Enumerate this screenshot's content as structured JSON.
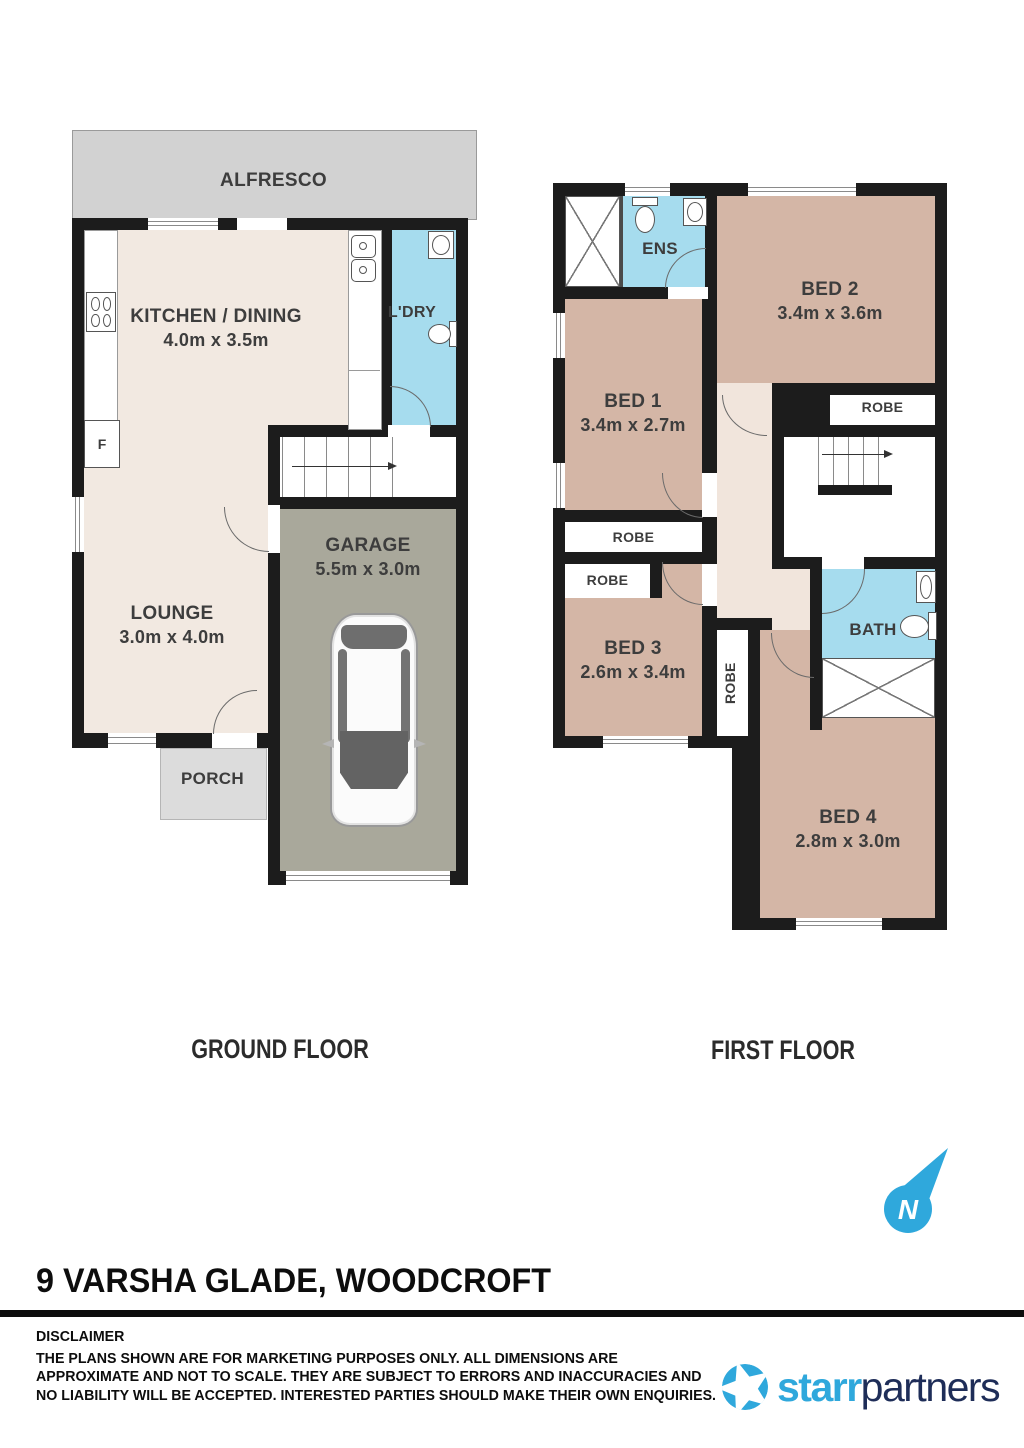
{
  "ground_floor": {
    "title": "GROUND FLOOR",
    "alfresco_label": "ALFRESCO",
    "kitchen_label": "KITCHEN / DINING",
    "kitchen_dims": "4.0m x 3.5m",
    "ldry_label": "L'DRY",
    "lounge_label": "LOUNGE",
    "lounge_dims": "3.0m x 4.0m",
    "garage_label": "GARAGE",
    "garage_dims": "5.5m x 3.0m",
    "porch_label": "PORCH",
    "fridge_label": "F"
  },
  "first_floor": {
    "title": "FIRST FLOOR",
    "ens_label": "ENS",
    "bed1_label": "BED 1",
    "bed1_dims": "3.4m x 2.7m",
    "bed2_label": "BED 2",
    "bed2_dims": "3.4m x 3.6m",
    "bed3_label": "BED 3",
    "bed3_dims": "2.6m x 3.4m",
    "bed4_label": "BED 4",
    "bed4_dims": "2.8m x 3.0m",
    "bath_label": "BATH",
    "robe_bed1_label": "ROBE",
    "robe_bed2_label": "ROBE",
    "robe_bed3_label": "ROBE",
    "robe_bed4_label": "ROBE"
  },
  "footer": {
    "address": "9 VARSHA GLADE, WOODCROFT",
    "disclaimer_heading": "DISCLAIMER",
    "disclaimer_line1": "THE PLANS SHOWN ARE FOR MARKETING PURPOSES ONLY. ALL DIMENSIONS ARE",
    "disclaimer_line2": "APPROXIMATE AND NOT TO SCALE. THEY ARE SUBJECT TO ERRORS AND INACCURACIES AND",
    "disclaimer_line3": "NO LIABILITY WILL BE ACCEPTED. INTERESTED PARTIES SHOULD MAKE THEIR OWN ENQUIRIES.",
    "brand_starr": "starr",
    "brand_partners": "partners",
    "compass_letter": "N"
  },
  "colors": {
    "wall": "#1c1c1c",
    "room_cream": "#f2e9e1",
    "hall_cream": "#f1e5dc",
    "bedroom_tan": "#d4b6a6",
    "wet_area_blue": "#a6dcee",
    "garage_olive": "#a9a89b",
    "outdoor_gray": "#d2d2d2",
    "porch_gray": "#dcdcdc",
    "brand_blue": "#2fa8dc",
    "brand_navy": "#1e2d58"
  }
}
